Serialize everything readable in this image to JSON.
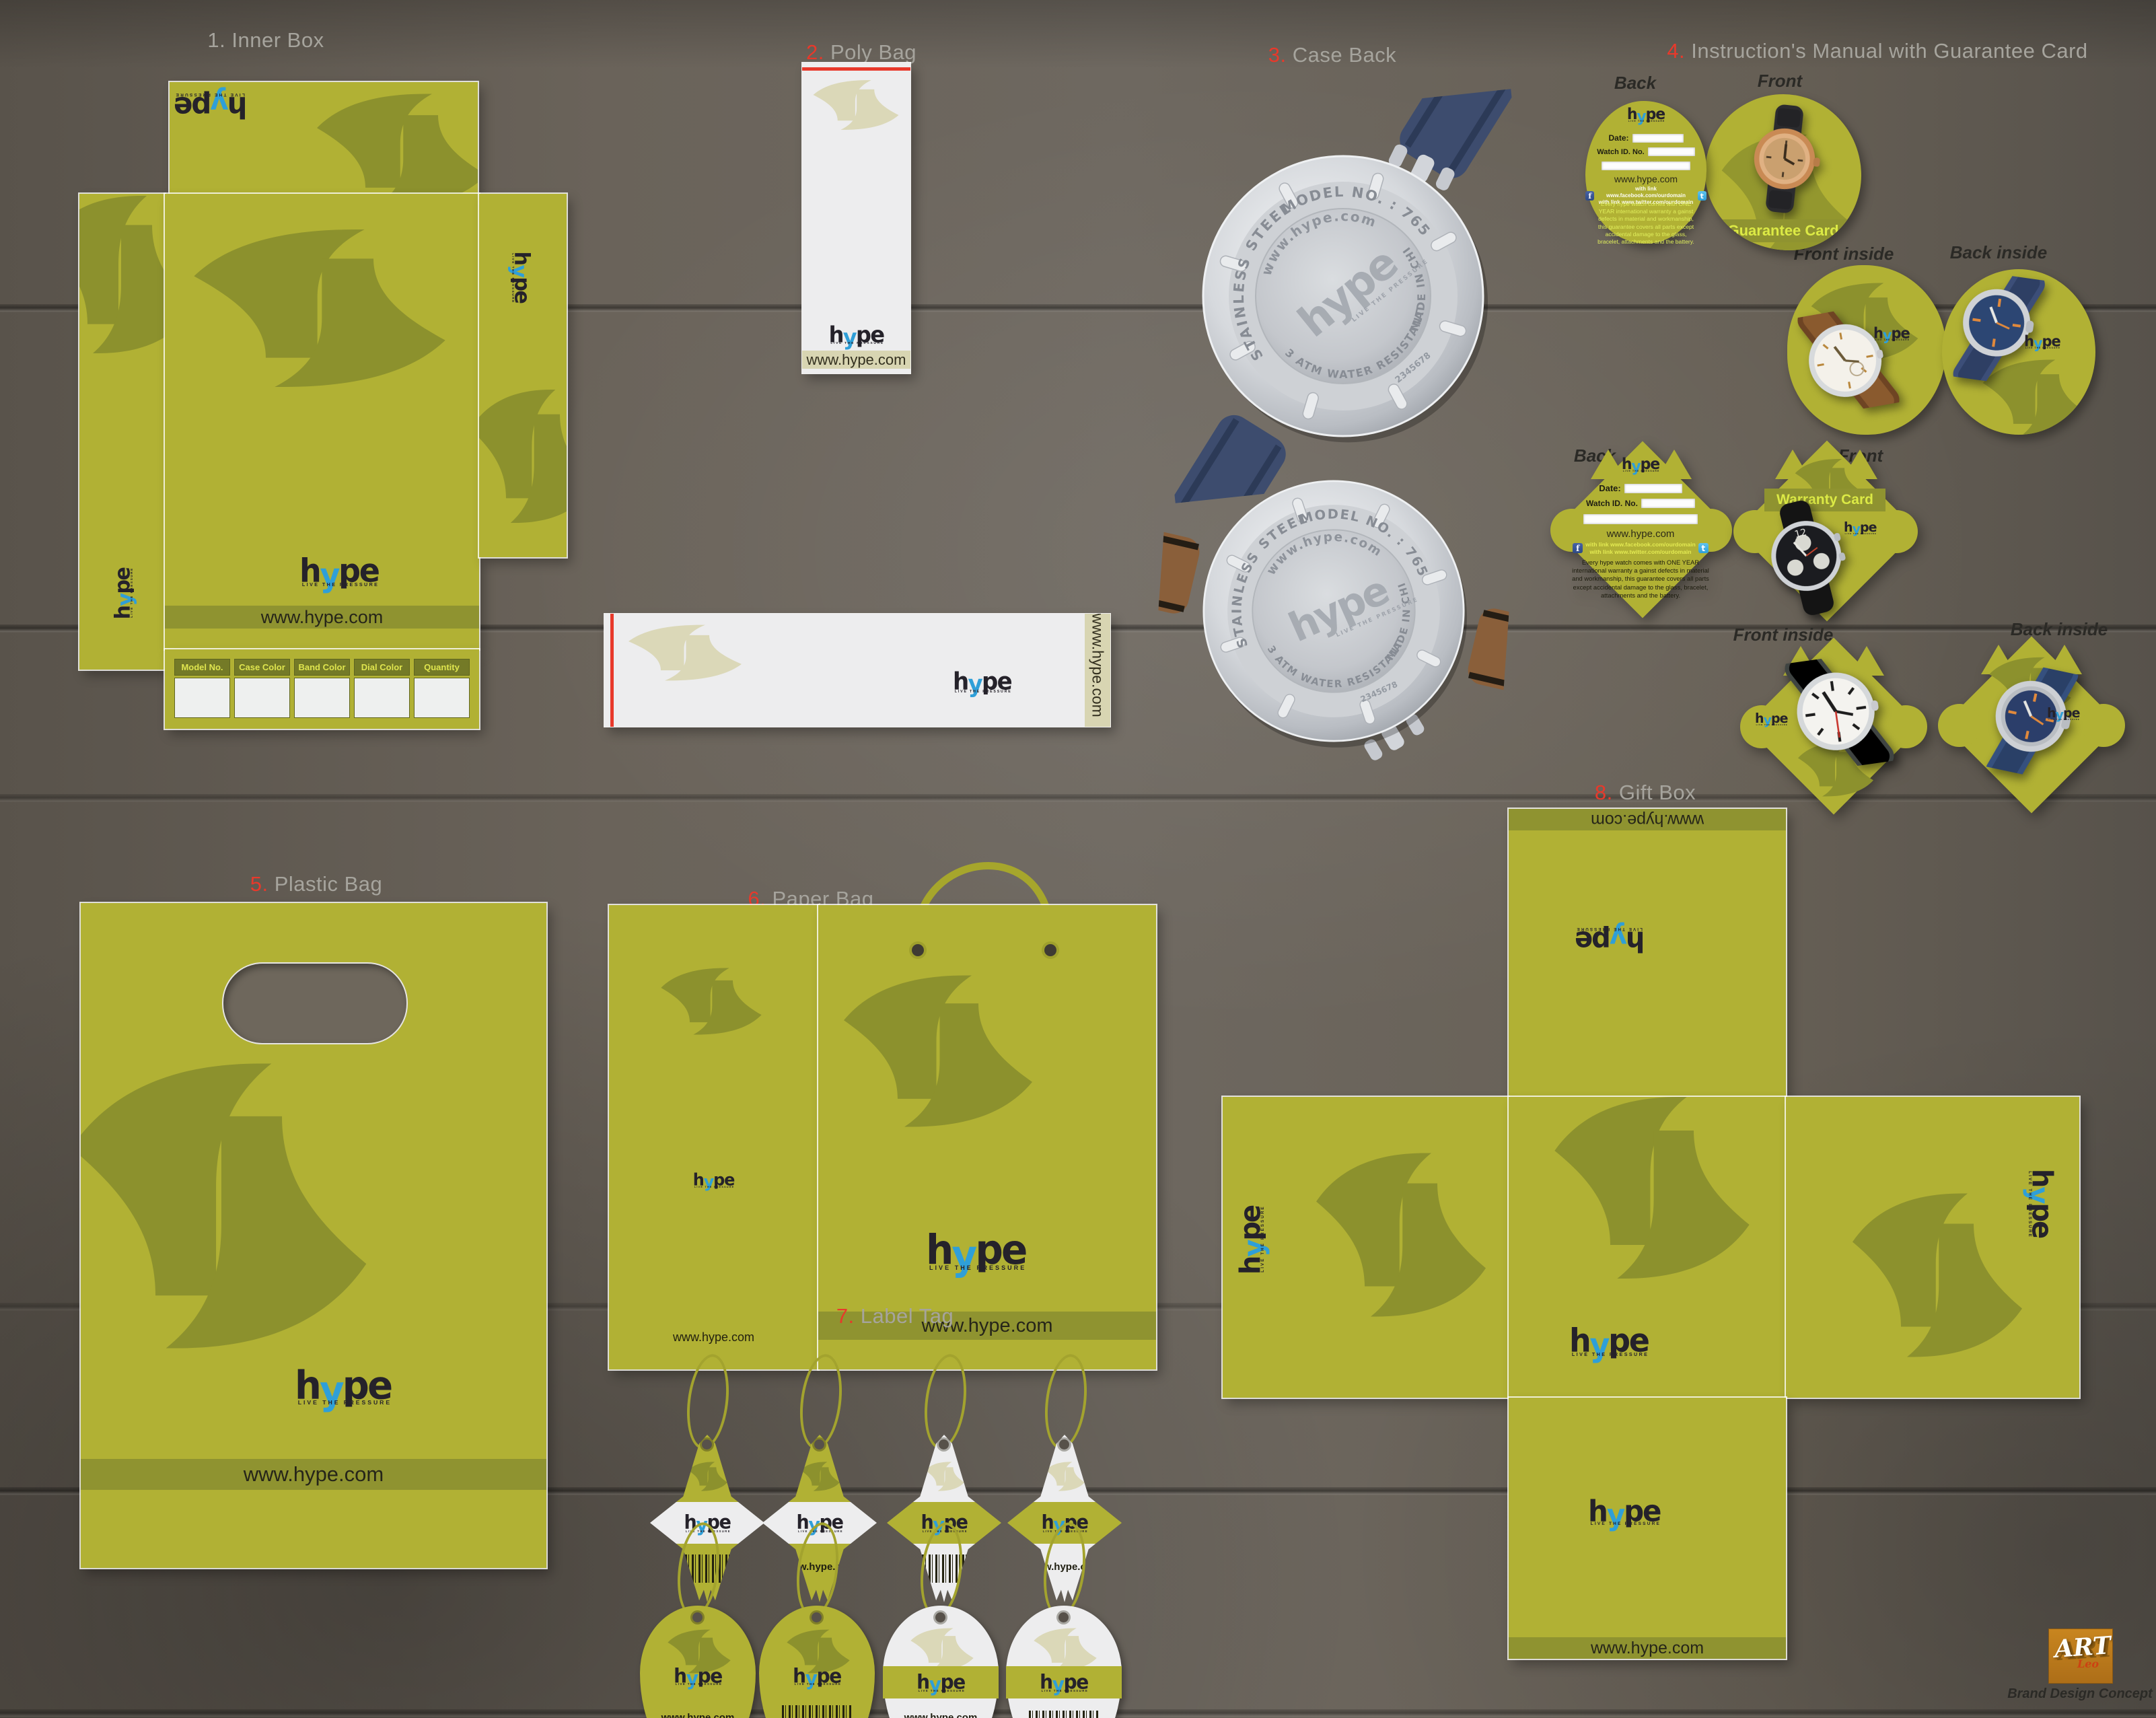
{
  "brand": {
    "name": "hype",
    "logo": {
      "h": "h",
      "y": "y",
      "pe": "pe",
      "tagline": "LIVE THE PRESSURE"
    },
    "website": "www.hype.com",
    "colors": {
      "olive": "#b1b134",
      "olive_dark": "#8f9330",
      "leaf_on_olive": "#8c912d",
      "beige": "#d8d5b2",
      "leaf_on_white": "#dbd8b8",
      "white_panel": "#ededee",
      "red": "#e8392b",
      "blue": "#2f9fd8",
      "ink": "#25222a",
      "pale_yellow": "#dfe54e"
    }
  },
  "sections": {
    "inner_box": {
      "num": "1.",
      "label": "Inner Box"
    },
    "poly_bag": {
      "num": "2.",
      "label": "Poly Bag"
    },
    "case_back": {
      "num": "3.",
      "label": "Case Back"
    },
    "manual": {
      "num": "4.",
      "label": "Instruction's Manual with Guarantee Card"
    },
    "plastic_bag": {
      "num": "5.",
      "label": "Plastic Bag"
    },
    "paper_bag": {
      "num": "6.",
      "label": "Paper Bag"
    },
    "label_tag": {
      "num": "7.",
      "label": "Label Tag"
    },
    "gift_box": {
      "num": "8.",
      "label": "Gift Box"
    }
  },
  "inner_box": {
    "table_headers": [
      "Model No.",
      "Case Color",
      "Band Color",
      "Dial Color",
      "Quantity"
    ]
  },
  "case_back": {
    "engravings": {
      "steel": "STAINLESS STEEL",
      "model": "MODEL NO. : 7654321",
      "website": "www.hype.com",
      "made": "MADE IN CHINA",
      "atm": "3 ATM WATER RESISTANT",
      "serial": "2345678"
    }
  },
  "manual": {
    "labels": {
      "back": "Back",
      "front": "Front",
      "front_inside": "Front inside",
      "back_inside": "Back inside"
    },
    "fields": {
      "date": "Date:",
      "watch_id": "Watch ID. No."
    },
    "links": {
      "facebook": "with link www.facebook.com/ourdomain",
      "twitter": "with link www.twitter.com/ourdomain"
    },
    "warranty_text": "Every hype watch comes with ONE YEAR international warranty a gainst defects in material and workmanship, this guarantee covers all parts except accidental damage to the glass, bracelet, attachments and the battery.",
    "guarantee_card": "Guarantee Card",
    "warranty_card": "Warranty Card"
  },
  "footer": {
    "art": "ART",
    "leo": "Leo",
    "subtitle": "Brand Design Concept"
  }
}
